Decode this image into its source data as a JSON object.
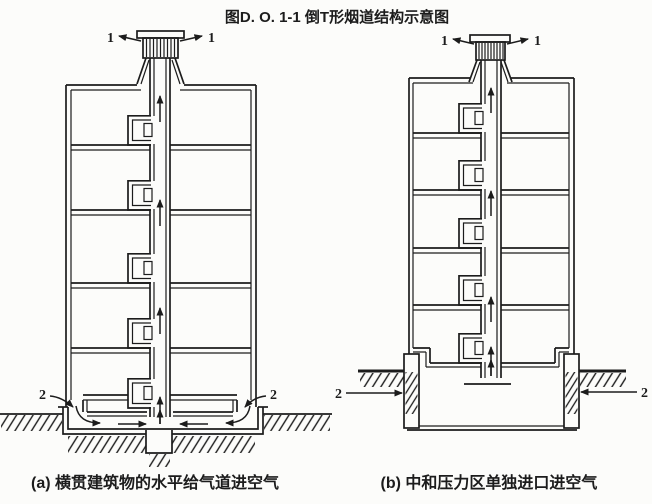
{
  "title": "图D. O. 1-1 倒T形烟道结构示意图",
  "colors": {
    "line": "#1c1c1c",
    "bg": "#fcfcfa"
  },
  "diagram_a": {
    "caption": "(a) 横贯建筑物的水平给气道进空气",
    "labels": {
      "outlet_left": "1",
      "outlet_right": "1",
      "inlet_left": "2",
      "inlet_right": "2"
    }
  },
  "diagram_b": {
    "caption": "(b) 中和压力区单独进口进空气",
    "labels": {
      "outlet_left": "1",
      "outlet_right": "1",
      "inlet_left": "2",
      "inlet_right": "2"
    }
  }
}
